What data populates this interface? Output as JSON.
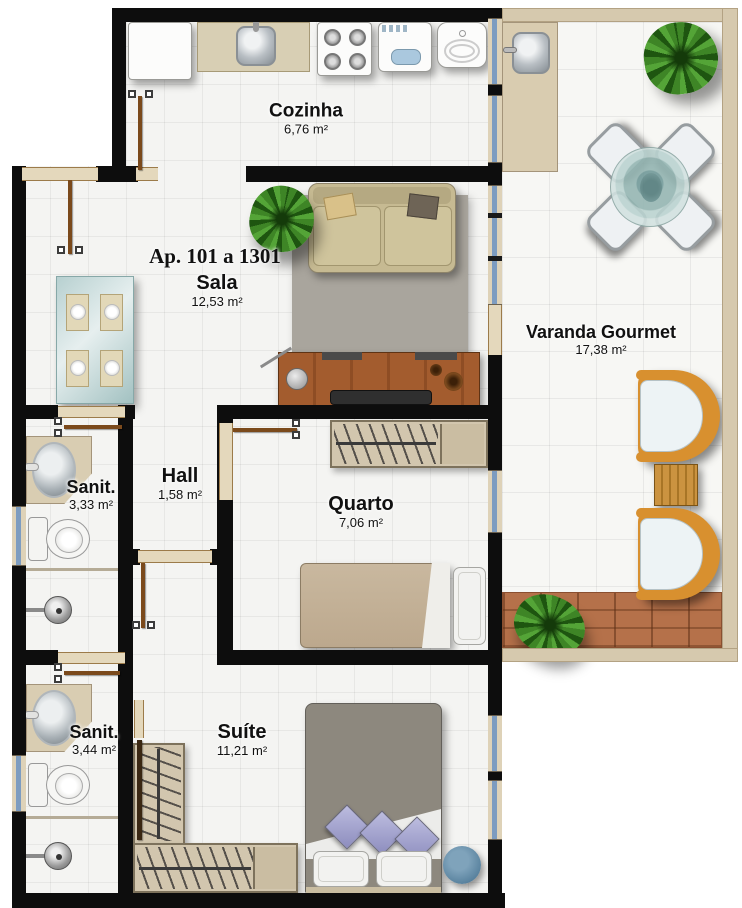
{
  "plan_title": "Ap. 101 a 1301",
  "rooms": {
    "cozinha": {
      "name": "Cozinha",
      "area": "6,76 m²"
    },
    "sala": {
      "name": "Sala",
      "area": "12,53 m²"
    },
    "varanda": {
      "name": "Varanda Gourmet",
      "area": "17,38 m²"
    },
    "hall": {
      "name": "Hall",
      "area": "1,58 m²"
    },
    "sanit1": {
      "name": "Sanit.",
      "area": "3,33 m²"
    },
    "quarto": {
      "name": "Quarto",
      "area": "7,06 m²"
    },
    "sanit2": {
      "name": "Sanit.",
      "area": "3,44 m²"
    },
    "suite": {
      "name": "Suíte",
      "area": "11,21 m²"
    }
  },
  "colors": {
    "wall": "#0d0d0d",
    "floor_tile": "#f4f4f2",
    "varanda_tile": "#f7f7f4",
    "door_wood": "#7b4a1c",
    "threshold": "#e4d8bc",
    "window_glass": "#7d9cc0",
    "deck_wood": "#b5714a",
    "parapet": "#d6c9ae",
    "sofa": "#c6ba92",
    "rattan_chair": "#d8902f",
    "pouf": "#5b84a0",
    "pillow_purple": "#a3a3cc",
    "glass_table": "#a9c4c4"
  }
}
